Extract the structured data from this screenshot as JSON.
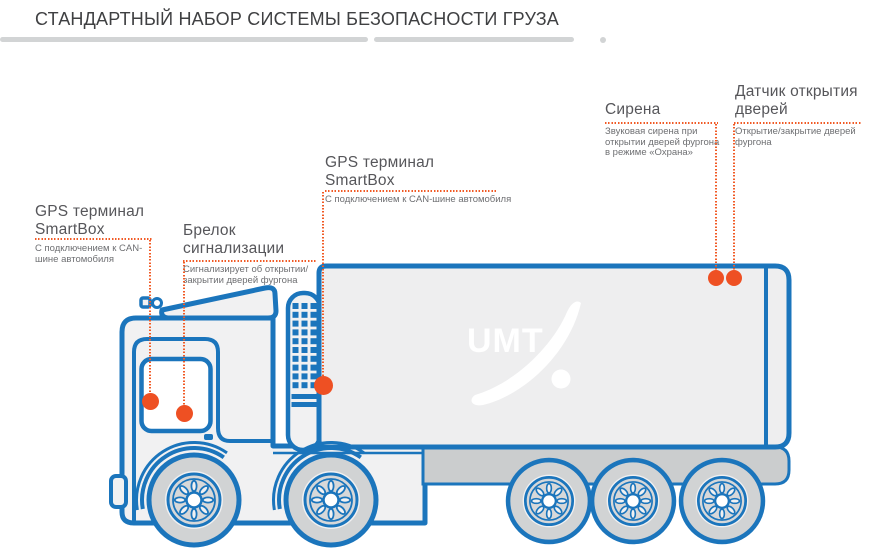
{
  "title": "СТАНДАРТНЫЙ НАБОР СИСТЕМЫ БЕЗОПАСНОСТИ ГРУЗА",
  "colors": {
    "accent_blue": "#1b75bc",
    "accent_orange": "#f15a24",
    "marker_orange": "#ee5023",
    "body_fill": "#f1f1f2",
    "trailer_fill": "#eeeeef",
    "wheel_fill": "#d1d3d4",
    "chassis_fill": "#cbcdce",
    "divider_gray": "#d2d4d5",
    "title_text": "#3f4042",
    "heading_text": "#56565a",
    "description_text": "#6e6f72"
  },
  "labels": [
    {
      "id": "gps-terminal-cab",
      "heading_lines": [
        "GPS терминал",
        "SmartBox"
      ],
      "desc_lines": [
        "С подключением к CAN-",
        "шине автомобиля"
      ]
    },
    {
      "id": "alarm-keyfob",
      "heading_lines": [
        "Брелок",
        "сигнализации"
      ],
      "desc_lines": [
        "Сигнализирует об открытии/",
        "закрытии дверей фургона"
      ]
    },
    {
      "id": "gps-terminal-chassis",
      "heading_lines": [
        "GPS терминал",
        "SmartBox"
      ],
      "desc_lines": [
        "С подключением к CAN-шине автомобиля"
      ]
    },
    {
      "id": "siren",
      "heading_lines": [
        "Сирена"
      ],
      "desc_lines": [
        "Звуковая сирена при",
        "открытии дверей фургона",
        "в режиме «Охрана»"
      ]
    },
    {
      "id": "door-open-sensor",
      "heading_lines": [
        "Датчик открытия",
        "дверей"
      ],
      "desc_lines": [
        "Открытие/закрытие дверей",
        "фургона"
      ]
    }
  ],
  "truck": {
    "logo": "UMT"
  }
}
